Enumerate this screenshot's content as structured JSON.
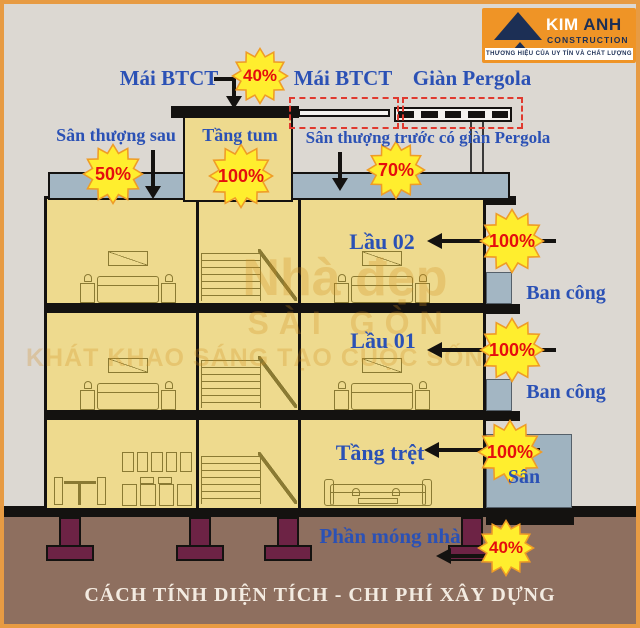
{
  "brand": {
    "name_first": "KIM",
    "name_last": " ANH",
    "subtitle": "CONSTRUCTION",
    "tagline": "THƯƠNG HIỆU CỦA UY TÍN VÀ CHẤT LƯỢNG"
  },
  "zones": {
    "roof_left": {
      "label": "Mái BTCT",
      "percent": "40%"
    },
    "roof_mid": {
      "label": "Mái BTCT"
    },
    "pergola": {
      "label": "Giàn Pergola"
    },
    "terrace_rear": {
      "label": "Sân thượng sau",
      "percent": "50%"
    },
    "tum": {
      "label": "Tầng tum",
      "percent": "100%"
    },
    "terrace_front": {
      "label": "Sân thượng trước có giàn Pergola",
      "percent": "70%"
    },
    "floor2": {
      "label": "Lầu 02",
      "percent": "100%"
    },
    "floor1": {
      "label": "Lầu 01",
      "percent": "100%"
    },
    "ground": {
      "label": "Tầng trệt",
      "percent": "100%"
    },
    "balcony_upper": {
      "label": "Ban công"
    },
    "balcony_lower": {
      "label": "Ban công"
    },
    "yard": {
      "label": "Sân"
    },
    "foundation": {
      "label": "Phần móng nhà",
      "percent": "40%"
    }
  },
  "watermark": {
    "line1": "Nhà đẹp",
    "line2": "SÀI GÒN",
    "line3": "KHÁT KHAO SÁNG TẠO CUỘC SỐNG"
  },
  "caption": "CÁCH TÍNH DIỆN TÍCH - CHI PHÍ XÂY DỰNG",
  "colors": {
    "frame_orange": "#e79b43",
    "label_blue": "#2b51b5",
    "badge_yellow": "#ffee2e",
    "badge_text_red": "#e50d0d",
    "dashed_red": "#e0392e",
    "interior_yellow": "#eeda8e",
    "slab_gray": "#a3b6c3",
    "ground_brown": "#8e6f5f",
    "footing_maroon": "#6d2345",
    "logo_orange": "#ef9426",
    "logo_navy": "#1c2f55"
  }
}
